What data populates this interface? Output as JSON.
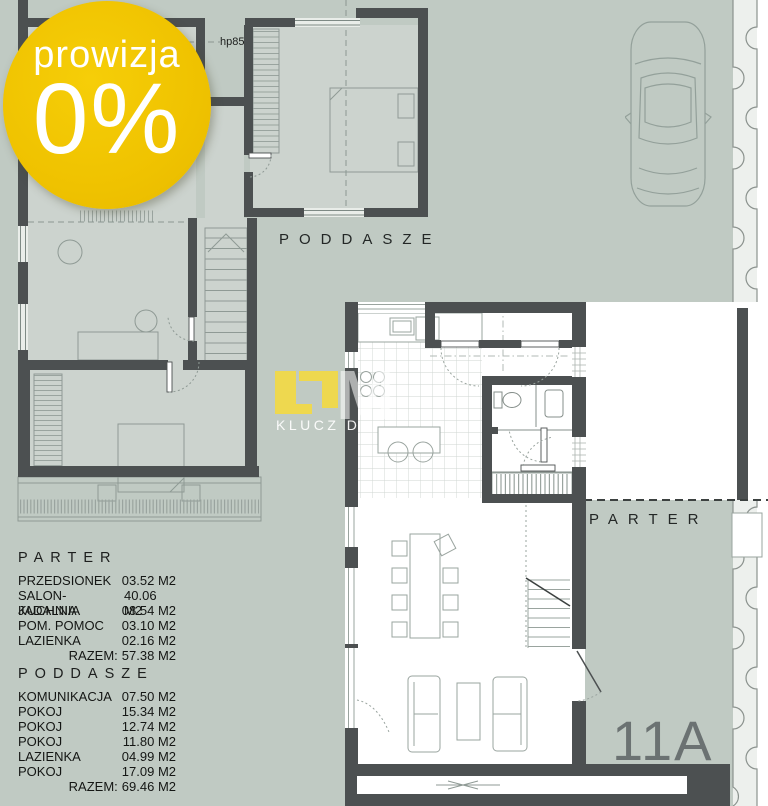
{
  "badge": {
    "top_text": "prowizja",
    "main_text": "0%"
  },
  "upper_plan": {
    "label": "PODDASZE",
    "height_note": "hp85"
  },
  "lower_plan": {
    "label": "PARTER",
    "unit_number": "11A"
  },
  "watermark": {
    "monogram": "M",
    "tagline": "KLUCZ DO"
  },
  "legend": {
    "parter": {
      "title": "PARTER",
      "rows": [
        {
          "label": "PRZEDSIONEK",
          "value": "03.52 M2"
        },
        {
          "label": "SALON-JADALNIA",
          "value": "40.06 M2"
        },
        {
          "label": "KUCHNIA",
          "value": "08.54 M2"
        },
        {
          "label": "POM. POMOC",
          "value": "03.10 M2"
        },
        {
          "label": "LAZIENKA",
          "value": "02.16 M2"
        }
      ],
      "total_label": "RAZEM:",
      "total_value": "57.38 M2"
    },
    "poddasze": {
      "title": "PODDASZE",
      "rows": [
        {
          "label": "KOMUNIKACJA",
          "value": "07.50 M2"
        },
        {
          "label": "POKOJ",
          "value": "15.34 M2"
        },
        {
          "label": "POKOJ",
          "value": "12.74 M2"
        },
        {
          "label": "POKOJ",
          "value": "11.80 M2"
        },
        {
          "label": "LAZIENKA",
          "value": "04.99 M2"
        },
        {
          "label": "POKOJ",
          "value": "17.09 M2"
        }
      ],
      "total_label": "RAZEM:",
      "total_value": "69.46 M2"
    }
  },
  "colors": {
    "background": "#c0cac3",
    "wall": "#4c5051",
    "badge_yellow": "#efc200",
    "logo_yellow": "#eed84f",
    "plan_white": "#ffffff"
  }
}
